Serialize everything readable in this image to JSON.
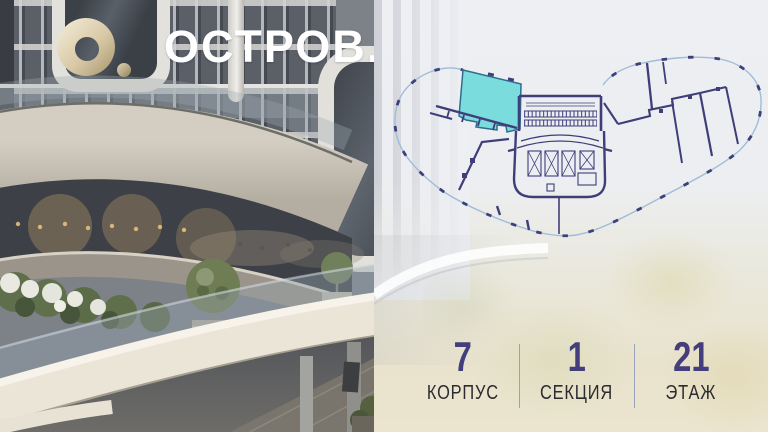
{
  "brand": {
    "wordmark": "ОСТРОВ.",
    "logo_icon": "o-ring-gold-icon",
    "logo_gold": "#D7C5A0",
    "wordmark_color": "#FFFFFF"
  },
  "floor_plan": {
    "highlighted_unit_color": "#7ADCDC",
    "highlighted_unit_border": "#2F6C90",
    "wall_color": "#403E79",
    "outline_color": "#9FBCD8"
  },
  "stats": {
    "items": [
      {
        "value": "7",
        "label": "КОРПУС"
      },
      {
        "value": "1",
        "label": "СЕКЦИЯ"
      },
      {
        "value": "21",
        "label": "ЭТАЖ"
      }
    ],
    "value_color": "#443E7C",
    "label_color": "#2B2B30",
    "divider_color": "#9AA2B8"
  }
}
